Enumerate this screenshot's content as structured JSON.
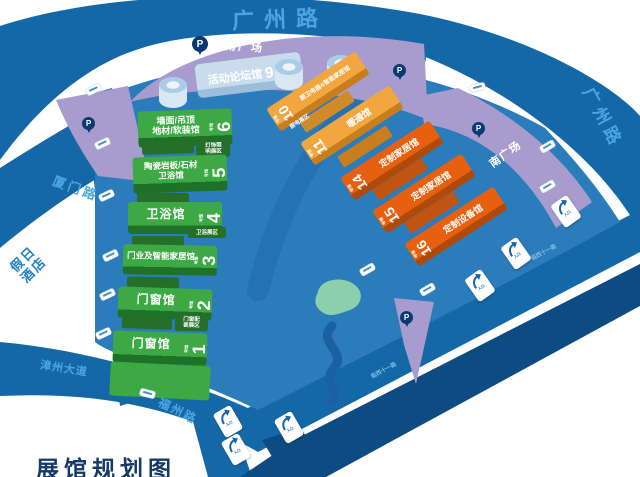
{
  "map_title": "展馆规划图",
  "roads": {
    "guangzhou_top": "广州路",
    "guangzhou_right": "广州路",
    "xiamen": "厦门路",
    "zhangzhou_avenue": "漳州大道",
    "fuzhou": "福州路",
    "outer_small": "临西十一路"
  },
  "plazas": {
    "southeast": "东南广场",
    "south": "南广场"
  },
  "hotel": {
    "line1": "假日",
    "line2": "酒店"
  },
  "parking": {
    "label": "P"
  },
  "entrance": {
    "label": "入口"
  },
  "halls": {
    "forum": {
      "name": "活动论坛馆",
      "num": "9",
      "suffix": "号馆"
    },
    "green": [
      {
        "line1": "墙面/吊顶",
        "line2": "地材/软装馆",
        "num": "6",
        "suffix": "号馆"
      },
      {
        "line1": "陶瓷岩板/石材",
        "line2": "卫浴馆",
        "num": "5",
        "suffix": "号馆"
      },
      {
        "line1": "卫浴馆",
        "line2": "",
        "num": "4",
        "suffix": "号馆"
      },
      {
        "line1": "门业及智能家居馆",
        "line2": "",
        "num": "3",
        "suffix": "号馆"
      },
      {
        "line1": "门窗馆",
        "line2": "",
        "num": "2",
        "suffix": "号馆"
      },
      {
        "line1": "门窗馆",
        "line2": "",
        "num": "1",
        "suffix": "号馆"
      }
    ],
    "orange": [
      {
        "name": "厨卫电器&智能家居馆",
        "num": "10",
        "suffix": "号馆"
      },
      {
        "name": "暖通馆",
        "num": "11",
        "suffix": "号馆"
      },
      {
        "name": "定制家居馆",
        "num": "14",
        "suffix": "号馆"
      },
      {
        "name": "定制家居馆",
        "num": "15",
        "suffix": "号馆"
      },
      {
        "name": "定制设备馆",
        "num": "16",
        "suffix": "号馆"
      }
    ]
  },
  "zones": {
    "lighting": {
      "line1": "灯饰照",
      "line2": "明展区"
    },
    "bathroom": {
      "label": "卫浴展区"
    },
    "window_accessories": {
      "line1": "门窗配",
      "line2": "套展区"
    },
    "kitchen_appliance": {
      "label": "厨电展区"
    }
  },
  "colors": {
    "road_blue": "#1568a8",
    "venue_blue": "#2b7cba",
    "dark_road": "#0e4b82",
    "plaza_purple": "#a79ccd",
    "hall_green": "#3ca944",
    "hall_green_dark": "#1f7127",
    "hall_orange_light": "#f2a63f",
    "hall_orange_deep": "#e7600f",
    "forum_blue": "#c9dcee",
    "lawn_teal": "#8ccfae",
    "road_label_blue": "#4ba6de",
    "navy": "#0b3a73"
  }
}
